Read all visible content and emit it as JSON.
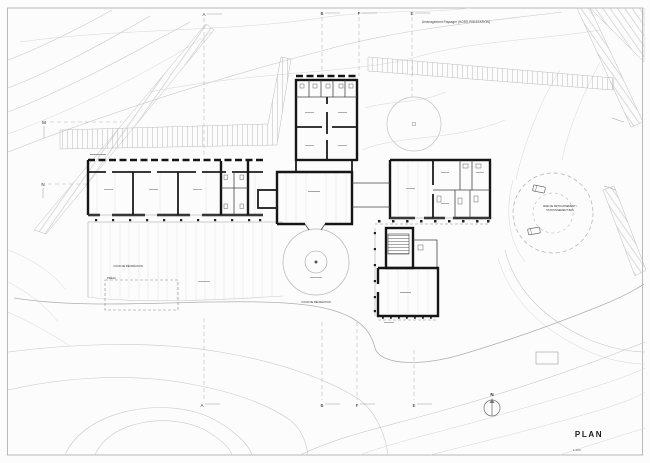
{
  "sheet": {
    "title": "PLAN",
    "scale": "1:200",
    "top_note": "Aménagement Paysager (HORS PRESTATION)",
    "north_label": "N"
  },
  "grid_markers": {
    "top": [
      "A",
      "B",
      "F",
      "E"
    ],
    "bottom": [
      "A",
      "B",
      "F",
      "E"
    ],
    "left": [
      "M",
      "N"
    ]
  },
  "labels": {
    "preau": "PRÉAU",
    "cour_elementaire": "COUR DE RÉCRÉATION",
    "cour_circle": "COUR DE RÉCRÉATION",
    "turnaround_line1": "AIRE DE RETOURNEMENT /",
    "turnaround_line2": "STATIONNEMENT BUS"
  },
  "colors": {
    "paper": "#fcfcfc",
    "contour": "#c9c9c9",
    "wall": "#161616"
  }
}
